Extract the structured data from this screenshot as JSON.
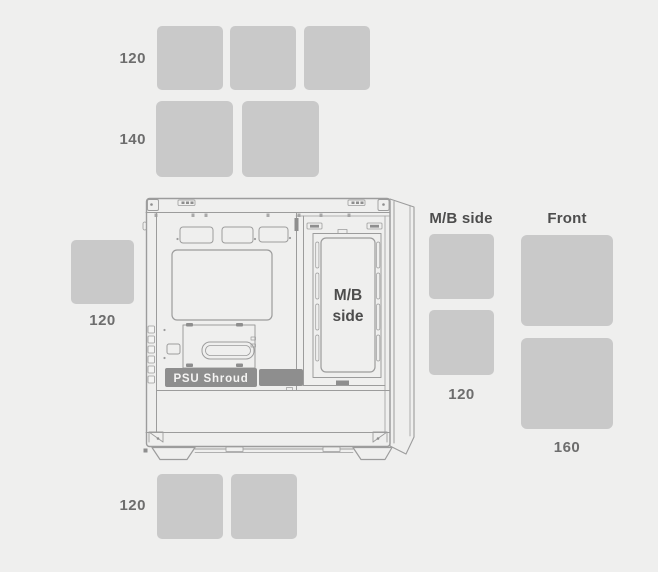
{
  "diagram_type": "pc-case-fan-layout",
  "fan_groups": [
    {
      "id": "top-row-120",
      "location": "top",
      "size_label": "120",
      "fan_count": 3
    },
    {
      "id": "top-row-140",
      "location": "top",
      "size_label": "140",
      "fan_count": 2
    },
    {
      "id": "rear-120",
      "location": "rear",
      "size_label": "120",
      "fan_count": 1
    },
    {
      "id": "mb-side-120",
      "location": "mb-side",
      "title": "M/B side",
      "size_label": "120",
      "fan_count": 2
    },
    {
      "id": "front-160",
      "location": "front",
      "title": "Front",
      "size_label": "160",
      "fan_count": 2
    },
    {
      "id": "bottom-120",
      "location": "bottom",
      "size_label": "120",
      "fan_count": 2
    }
  ],
  "case_diagram": {
    "mb_side_label_line1": "M/B",
    "mb_side_label_line2": "side",
    "psu_shroud_label": "PSU Shroud"
  },
  "colors": {
    "background": "#efefee",
    "fan_slot": "#c9c9c9",
    "line_art": "#9c9c9c",
    "dark_fill": "#8e8e8e",
    "title_text": "#4d4d4d",
    "size_text": "#6d6d6d",
    "shroud_text": "#f5f4f3"
  }
}
